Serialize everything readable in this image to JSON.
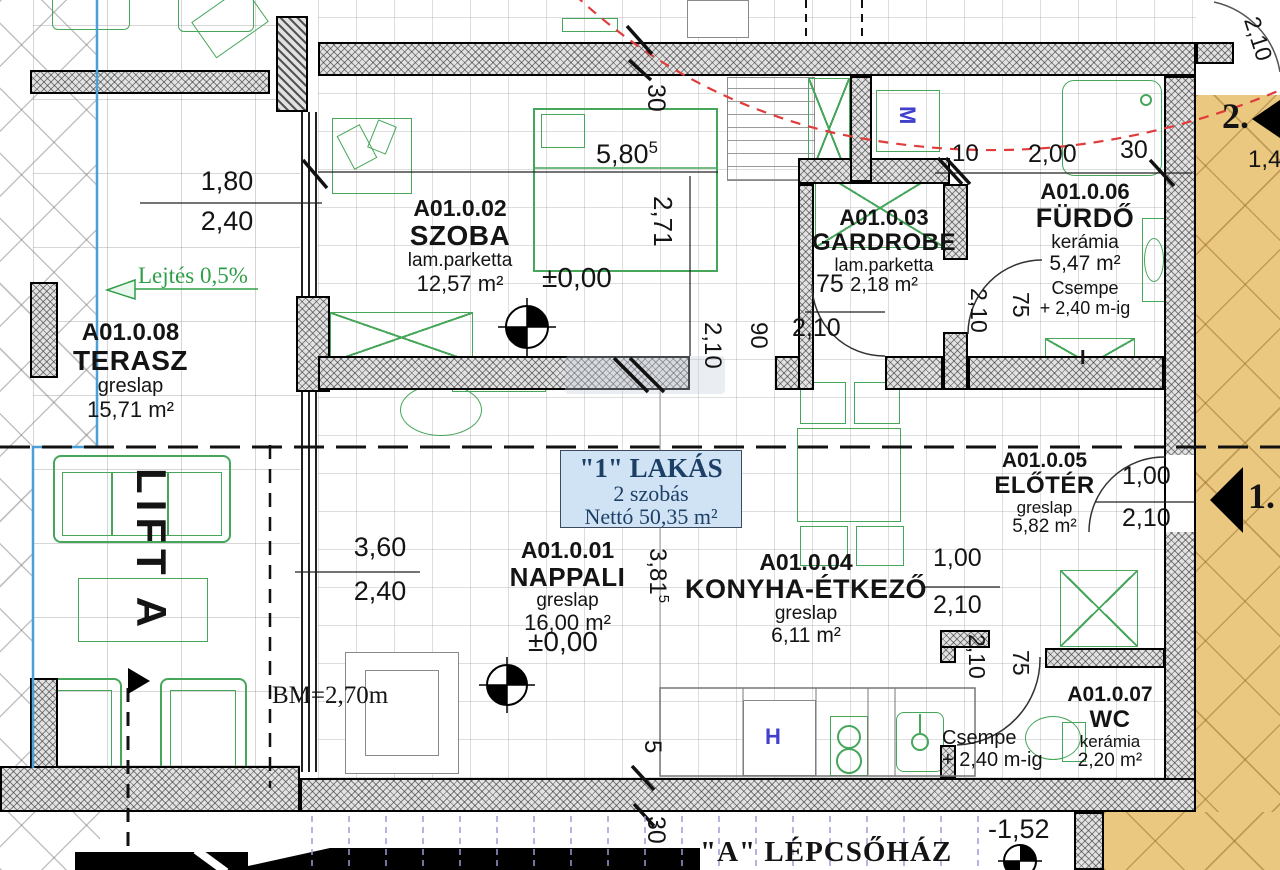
{
  "title_block": {
    "apartment": "\"1\" LAKÁS",
    "type": "2 szobás",
    "net_area": "Nettó 50,35 m²"
  },
  "rooms": [
    {
      "code": "A01.0.02",
      "name": "SZOBA",
      "finish": "lam.parketta",
      "area": "12,57 m²"
    },
    {
      "code": "A01.0.03",
      "name": "GARDROBE",
      "finish": "lam.parketta",
      "area": "2,18 m²"
    },
    {
      "code": "A01.0.06",
      "name": "FÜRDŐ",
      "finish": "kerámia",
      "area": "5,47 m²",
      "note1": "Csempe",
      "note2": "+ 2,40 m-ig"
    },
    {
      "code": "A01.0.08",
      "name": "TERASZ",
      "finish": "greslap",
      "area": "15,71 m²"
    },
    {
      "code": "A01.0.01",
      "name": "NAPPALI",
      "finish": "greslap",
      "area": "16,00 m²"
    },
    {
      "code": "A01.0.04",
      "name": "KONYHA-ÉTKEZŐ",
      "finish": "greslap",
      "area": "6,11 m²"
    },
    {
      "code": "A01.0.05",
      "name": "ELŐTÉR",
      "finish": "greslap",
      "area": "5,82 m²"
    },
    {
      "code": "A01.0.07",
      "name": "WC",
      "finish": "kerámia",
      "area": "2,20 m²",
      "note1": "Csempe",
      "note2": "+ 2,40 m-ig"
    }
  ],
  "labels": {
    "lift": "LIFT A",
    "staircase": "\"A\" LÉPCSŐHÁZ",
    "slope": "Lejtés 0,5%",
    "beam_height": "BM=2,70m",
    "level_zero": "±0,00",
    "level_stair": "-1,52",
    "entry1": "1.",
    "entry2": "2.",
    "fridge": "H",
    "washer": "M",
    "cabinet": "I"
  },
  "dims": {
    "w180": "1,80",
    "w240": "2,40",
    "w580": "5,80",
    "w580s": "5",
    "h271": "2,71",
    "t30": "30",
    "n10": "10",
    "n200": "2,00",
    "n30": "30",
    "arc210": "2,10",
    "n14": "1,4",
    "g75": "75",
    "g210": "2,10",
    "d90": "90",
    "d210": "2,10",
    "f210": "2,10",
    "f75": "75",
    "n360": "3,60",
    "n240": "2,40",
    "h381": "3,81",
    "h381s": "5",
    "k100": "1,00",
    "k210": "2,10",
    "e100": "1,00",
    "e210": "2,10",
    "wc210": "2,10",
    "wc75": "75",
    "b5": "5",
    "b30": "30"
  },
  "colors": {
    "furniture_green": "#46a65a",
    "corridor_tan": "#eac87f",
    "escape_route_red": "#e03c3c",
    "apartment_box_bg": "#cfe3f5",
    "apartment_box_text": "#1d3f66",
    "stair_tread_blue": "#9b9bd6",
    "terrace_edge_blue": "#4d9fd8",
    "appliance_blue": "#4040cc"
  }
}
